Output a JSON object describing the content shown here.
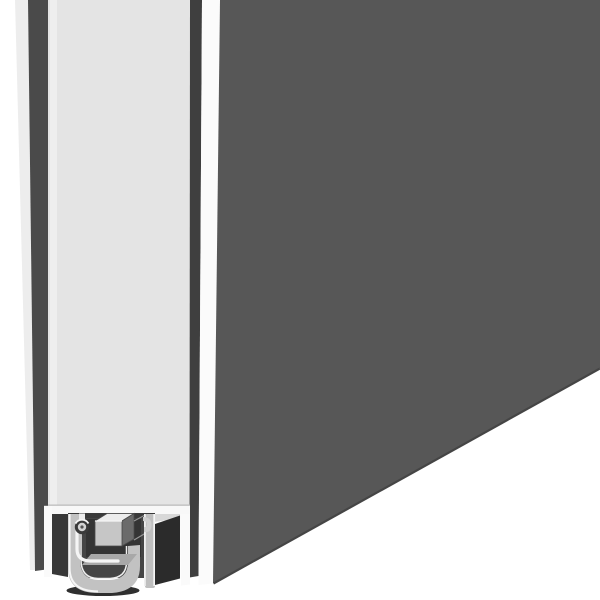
{
  "scene": {
    "kind": "3d-product-cutaway-illustration",
    "subject": "door-bottom-drop-seal-cross-section",
    "background": "#ffffff"
  },
  "parts": [
    {
      "name": "door-leaf-dark-face"
    },
    {
      "name": "door-leaf-edge"
    },
    {
      "name": "seal-housing-profile"
    },
    {
      "name": "rubber-seal-channel"
    },
    {
      "name": "drop-mechanism-block"
    },
    {
      "name": "pivot-pin"
    }
  ],
  "colors": {
    "background": "#ffffff",
    "door_face_dark": "#575757",
    "door_face_edge_line": "#454545",
    "left_back_face": "#4a4a4a",
    "left_back_highlight": "#ededed",
    "door_edge_light": "#e4e4e4",
    "door_edge_highlight": "#eeeeee",
    "corner_gap_dark": "#3f3f3f",
    "corner_strip_white": "#fbfbfb",
    "door_bottom_line": "#bdbdbd",
    "door_bottom_band": "#f8f8f8",
    "door_bottom_sliver": "#d8d8d8",
    "under_door_shadow": "#383838",
    "under_door_highlight": "#fafafa",
    "housing_metal": "#c2c2c2",
    "housing_metal_right": "#bfbfbf",
    "housing_top_shadow": "#3a3a3a",
    "housing_cavity": "#454545",
    "cavity_deep": "#343434",
    "seal_face_dark": "#2b2b2b",
    "seal_inner_shelf": "#a8a8a8",
    "seal_bottom_shadow": "#2f2f2f",
    "highlight_white": "#f5f5f5",
    "inner_edge_highlight": "#efefef",
    "block_front": "#c6c6c6",
    "block_top": "#ececec",
    "block_side": "#6b6b6b",
    "block_outline": "#4a4a4a",
    "pin_ring": "#3a3a3a",
    "pin_core": "#d4d4d4",
    "pin_center": "#555555",
    "recede_line": "#969696",
    "lip_metal": "#cfcfcf"
  }
}
